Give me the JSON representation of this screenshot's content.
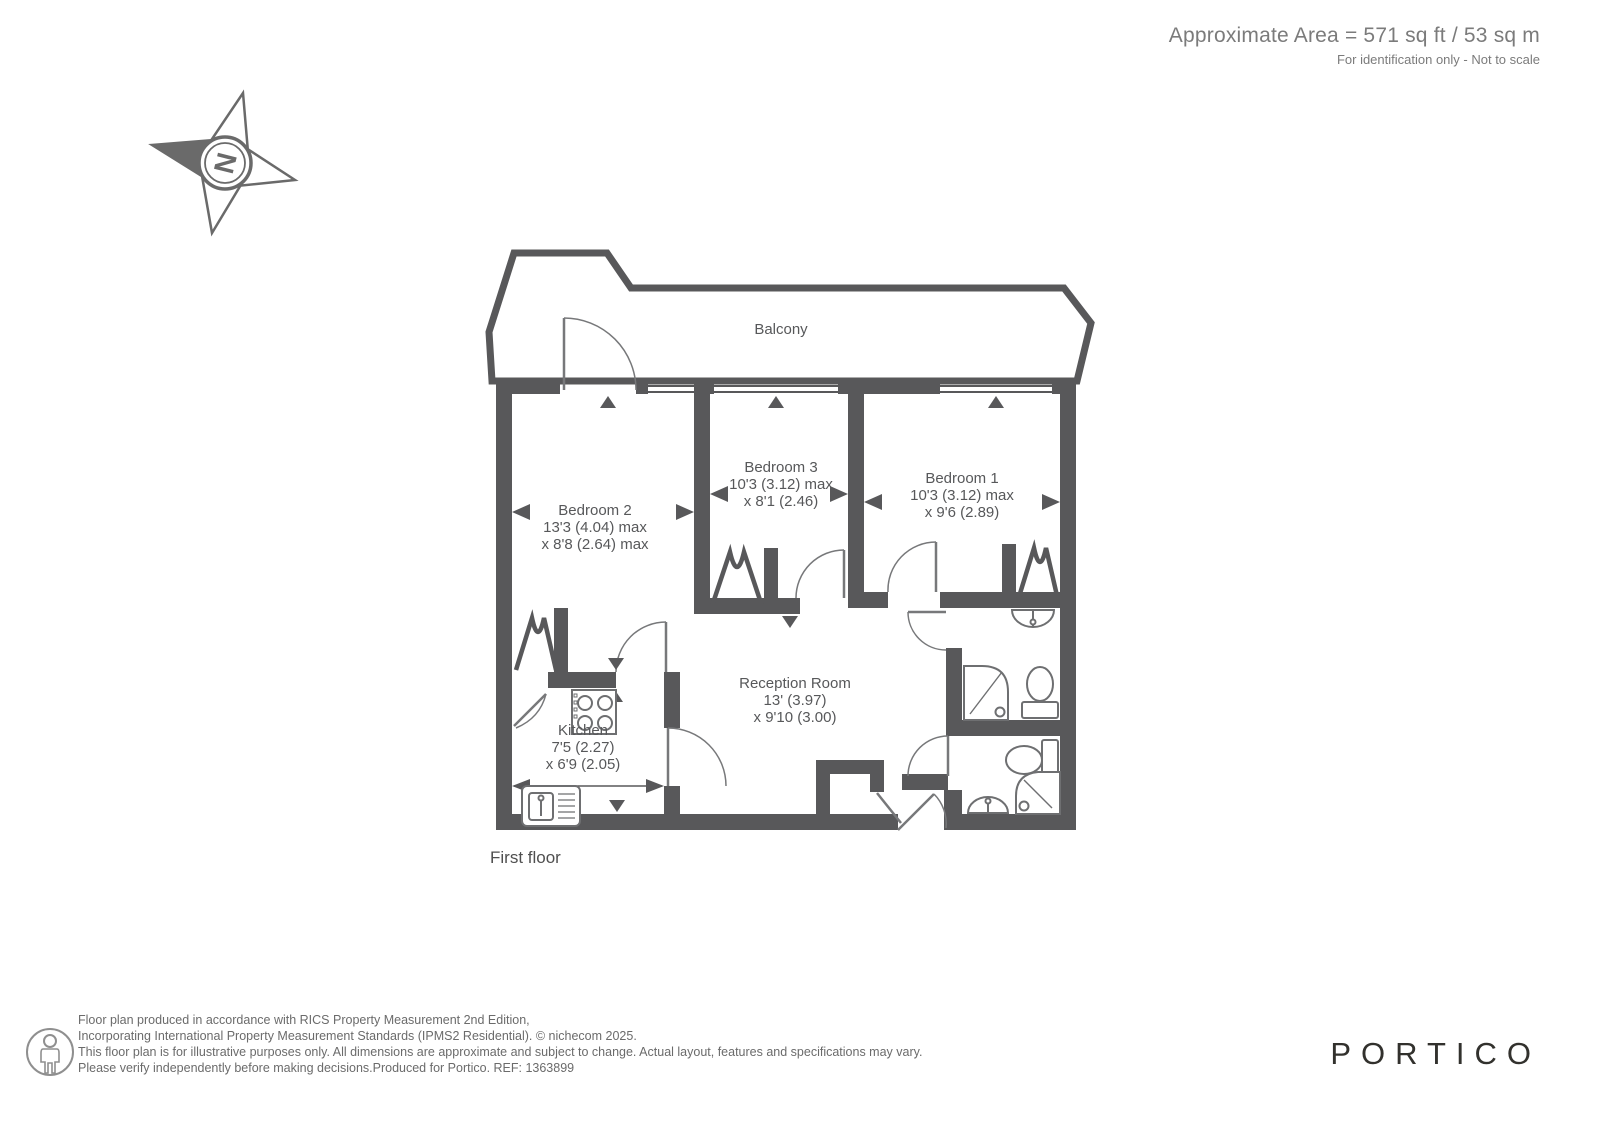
{
  "header": {
    "title": "Approximate Area = 571 sq ft / 53 sq m",
    "subtitle": "For identification only - Not to scale"
  },
  "compass": {
    "label": "N"
  },
  "plan": {
    "floor_label": "First floor",
    "rooms": [
      {
        "id": "balcony",
        "name": "Balcony",
        "dim1": "",
        "dim2": ""
      },
      {
        "id": "bedroom2",
        "name": "Bedroom 2",
        "dim1": "13'3 (4.04) max",
        "dim2": "x 8'8 (2.64) max"
      },
      {
        "id": "bedroom3",
        "name": "Bedroom 3",
        "dim1": "10'3 (3.12) max",
        "dim2": "x 8'1 (2.46)"
      },
      {
        "id": "bedroom1",
        "name": "Bedroom 1",
        "dim1": "10'3 (3.12) max",
        "dim2": "x 9'6 (2.89)"
      },
      {
        "id": "reception",
        "name": "Reception Room",
        "dim1": "13' (3.97)",
        "dim2": "x 9'10 (3.00)"
      },
      {
        "id": "kitchen",
        "name": "Kitchen",
        "dim1": "7'5 (2.27)",
        "dim2": "x 6'9 (2.05)"
      }
    ]
  },
  "footer": {
    "disclaimer_lines": [
      "Floor plan produced in accordance with RICS Property Measurement 2nd Edition,",
      "Incorporating International Property Measurement Standards (IPMS2 Residential).   © nichecom 2025.",
      "This floor plan is for illustrative purposes only. All dimensions are approximate and subject to change. Actual layout, features and specifications may vary.",
      "Please verify independently before making decisions.Produced for Portico.   REF:  1363899"
    ],
    "logo": "PORTICO"
  },
  "colors": {
    "wall": "#58585a",
    "thin_line": "#77787a",
    "logo": "#32312d"
  }
}
